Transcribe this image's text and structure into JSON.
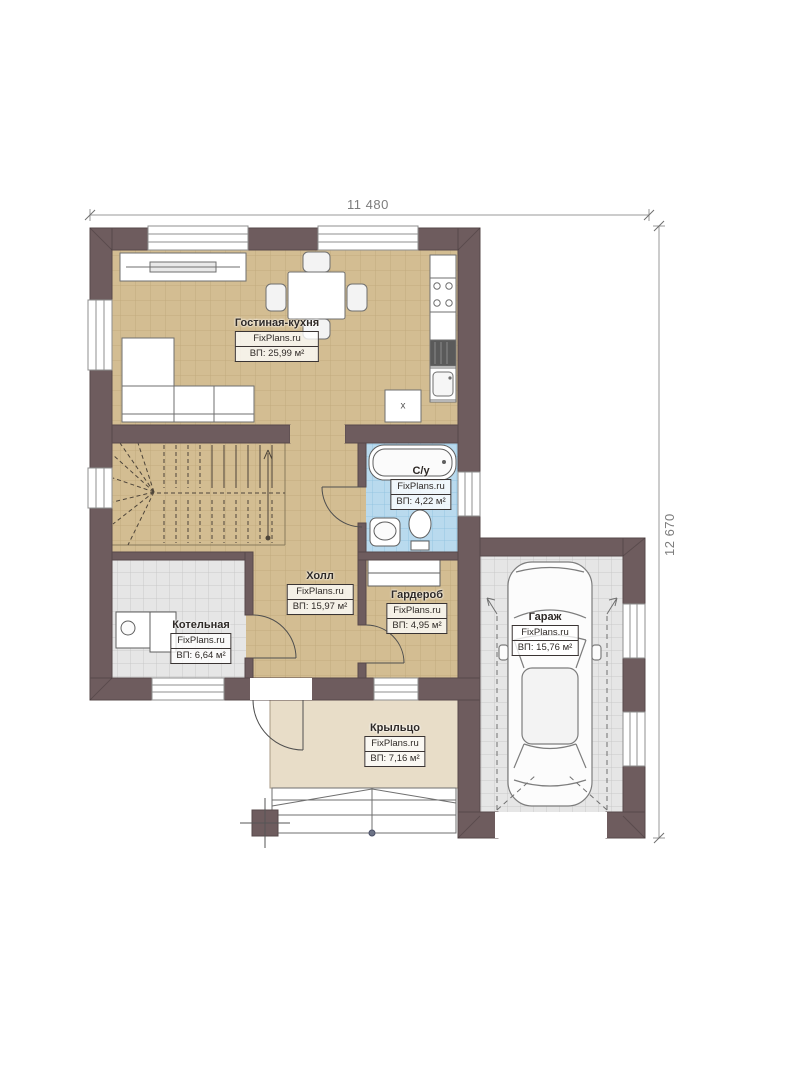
{
  "dimensions": {
    "width_label": "11 480",
    "height_label": "12 670"
  },
  "rooms": [
    {
      "id": "living-kitchen",
      "name": "Гостиная-кухня",
      "brand": "FixPlans.ru",
      "area": "ВП: 25,99 м²"
    },
    {
      "id": "bathroom",
      "name": "С/у",
      "brand": "FixPlans.ru",
      "area": "ВП: 4,22 м²"
    },
    {
      "id": "hall",
      "name": "Холл",
      "brand": "FixPlans.ru",
      "area": "ВП: 15,97 м²"
    },
    {
      "id": "wardrobe",
      "name": "Гардероб",
      "brand": "FixPlans.ru",
      "area": "ВП: 4,95 м²"
    },
    {
      "id": "boiler-room",
      "name": "Котельная",
      "brand": "FixPlans.ru",
      "area": "ВП: 6,64 м²"
    },
    {
      "id": "garage",
      "name": "Гараж",
      "brand": "FixPlans.ru",
      "area": "ВП: 15,76 м²"
    },
    {
      "id": "porch",
      "name": "Крыльцо",
      "brand": "FixPlans.ru",
      "area": "ВП: 7,16 м²"
    }
  ],
  "annotations": {
    "kitchen_box_label": "x"
  },
  "colors": {
    "wall": "#6e5c5e",
    "wood_floor": "#d3bd92",
    "bath_floor": "#b9daee",
    "tile_floor": "#e6e6e6",
    "porch_floor": "#e8ddc8",
    "dimension": "#7c7c7c",
    "label_border": "#3a3433"
  }
}
